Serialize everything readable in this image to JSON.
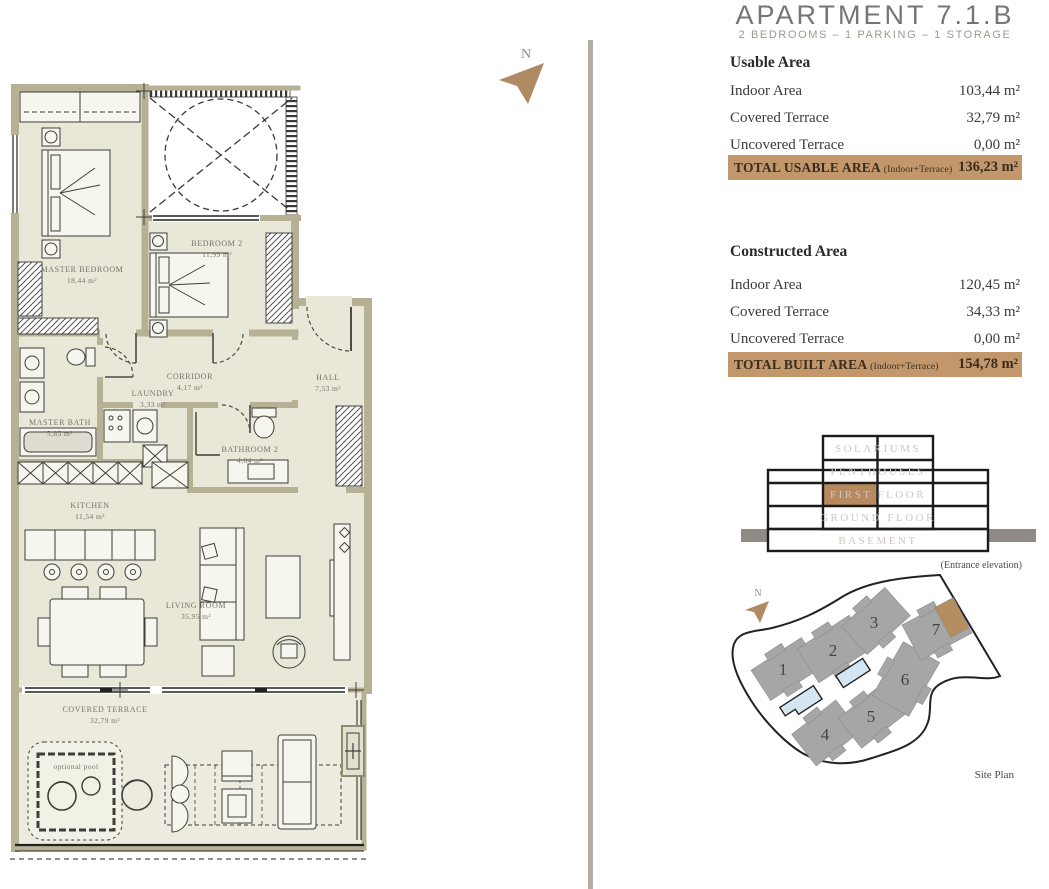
{
  "header": {
    "title": "APARTMENT 7.1.B",
    "subtitle": "2 BEDROOMS – 1 PARKING – 1 STORAGE"
  },
  "usable_area": {
    "heading": "Usable Area",
    "rows": [
      {
        "label": "Indoor Area",
        "value": "103,44 m²"
      },
      {
        "label": "Covered Terrace",
        "value": "32,79 m²"
      },
      {
        "label": "Uncovered Terrace",
        "value": "0,00 m²"
      }
    ],
    "total_label": "TOTAL USABLE AREA",
    "total_note": "(Indoor+Terrace)",
    "total_value": "136,23 m²"
  },
  "constructed_area": {
    "heading": "Constructed Area",
    "rows": [
      {
        "label": "Indoor Area",
        "value": "120,45 m²"
      },
      {
        "label": "Covered Terrace",
        "value": "34,33 m²"
      },
      {
        "label": "Uncovered Terrace",
        "value": "0,00 m²"
      }
    ],
    "total_label": "TOTAL BUILT AREA",
    "total_note": "(Indoor+Terrace)",
    "total_value": "154,78 m²"
  },
  "elevation": {
    "floors": [
      "SOLARIUMS",
      "PENTHOUSES",
      "FIRST FLOOR",
      "GROUND FLOOR",
      "BASEMENT"
    ],
    "highlight_floor": "FIRST FLOOR",
    "caption": "(Entrance elevation)"
  },
  "site_plan": {
    "label": "Site Plan",
    "north_label": "N",
    "buildings": [
      "1",
      "2",
      "3",
      "4",
      "5",
      "6",
      "7"
    ],
    "highlighted_building": "7"
  },
  "floor_plan": {
    "north_label": "N",
    "pool_label": "optional pool",
    "rooms": [
      {
        "name": "MASTER BEDROOM",
        "area": "18,44 m²"
      },
      {
        "name": "BEDROOM 2",
        "area": "11,99 m²"
      },
      {
        "name": "CORRIDOR",
        "area": "4,17 m²"
      },
      {
        "name": "HALL",
        "area": "7,53 m²"
      },
      {
        "name": "MASTER BATH",
        "area": "5,85 m²"
      },
      {
        "name": "LAUNDRY",
        "area": "3,33 m²"
      },
      {
        "name": "BATHROOM 2",
        "area": "4,64 m²"
      },
      {
        "name": "KITCHEN",
        "area": "11,54 m²"
      },
      {
        "name": "LIVING ROOM",
        "area": "35,95 m²"
      },
      {
        "name": "COVERED TERRACE",
        "area": "32,79 m²"
      }
    ]
  },
  "colors": {
    "accent_bar": "#c2976b",
    "elevation_highlight": "#b68a5e",
    "site_highlight": "#b48d60",
    "wall": "#b6b094",
    "floor": "#e9e7d8",
    "pool_blue": "#d3e6f2",
    "building_gray": "#a6a6a6"
  }
}
